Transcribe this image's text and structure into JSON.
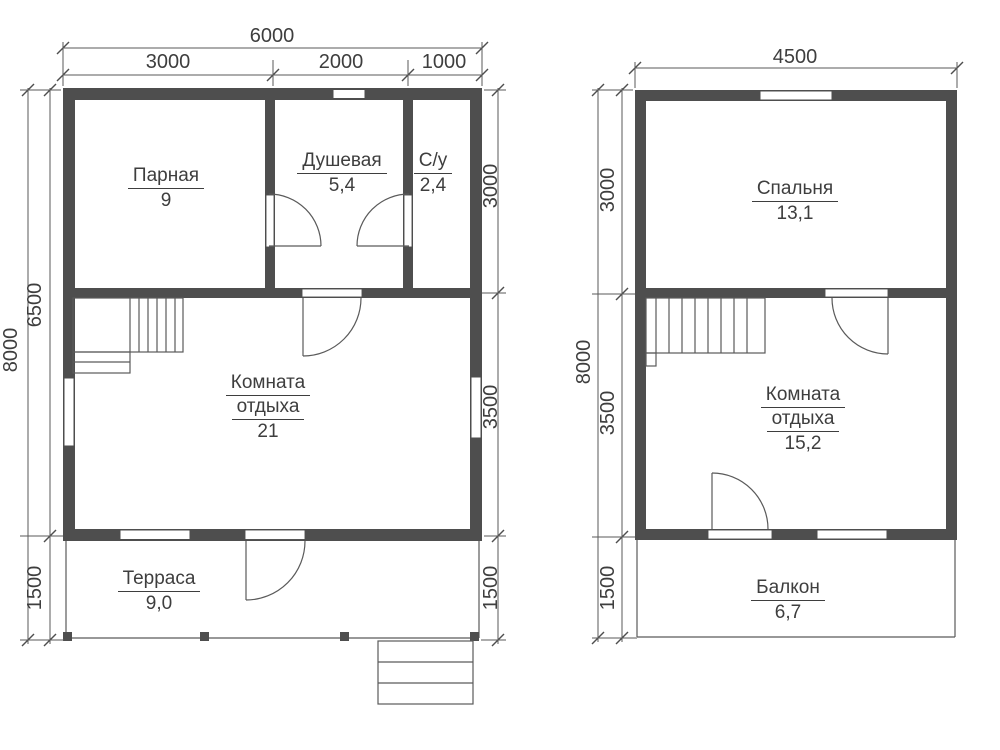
{
  "colors": {
    "wall": "#4e4e4e",
    "line": "#5a5a5a",
    "text": "#3e3e3e",
    "background": "#ffffff"
  },
  "floor1": {
    "dim_top_total": "6000",
    "dim_top_seg1": "3000",
    "dim_top_seg2": "2000",
    "dim_top_seg3": "1000",
    "dim_left_outer": "8000",
    "dim_left_upper": "6500",
    "dim_left_lower": "1500",
    "dim_right_upper": "3000",
    "dim_right_middle": "3500",
    "dim_right_lower": "1500",
    "rooms": {
      "parnaya": {
        "name": "Парная",
        "area": "9"
      },
      "dushevaya": {
        "name": "Душевая",
        "area": "5,4"
      },
      "su": {
        "name": "С/у",
        "area": "2,4"
      },
      "lounge": {
        "name_line1": "Комната",
        "name_line2": "отдыха",
        "area": "21"
      },
      "terrace": {
        "name": "Терраса",
        "area": "9,0"
      }
    }
  },
  "floor2": {
    "dim_top_total": "4500",
    "dim_left_outer": "8000",
    "dim_left_upper": "3000",
    "dim_left_middle": "3500",
    "dim_left_lower": "1500",
    "rooms": {
      "bedroom": {
        "name": "Спальня",
        "area": "13,1"
      },
      "lounge": {
        "name_line1": "Комната",
        "name_line2": "отдыха",
        "area": "15,2"
      },
      "balcony": {
        "name": "Балкон",
        "area": "6,7"
      }
    }
  }
}
